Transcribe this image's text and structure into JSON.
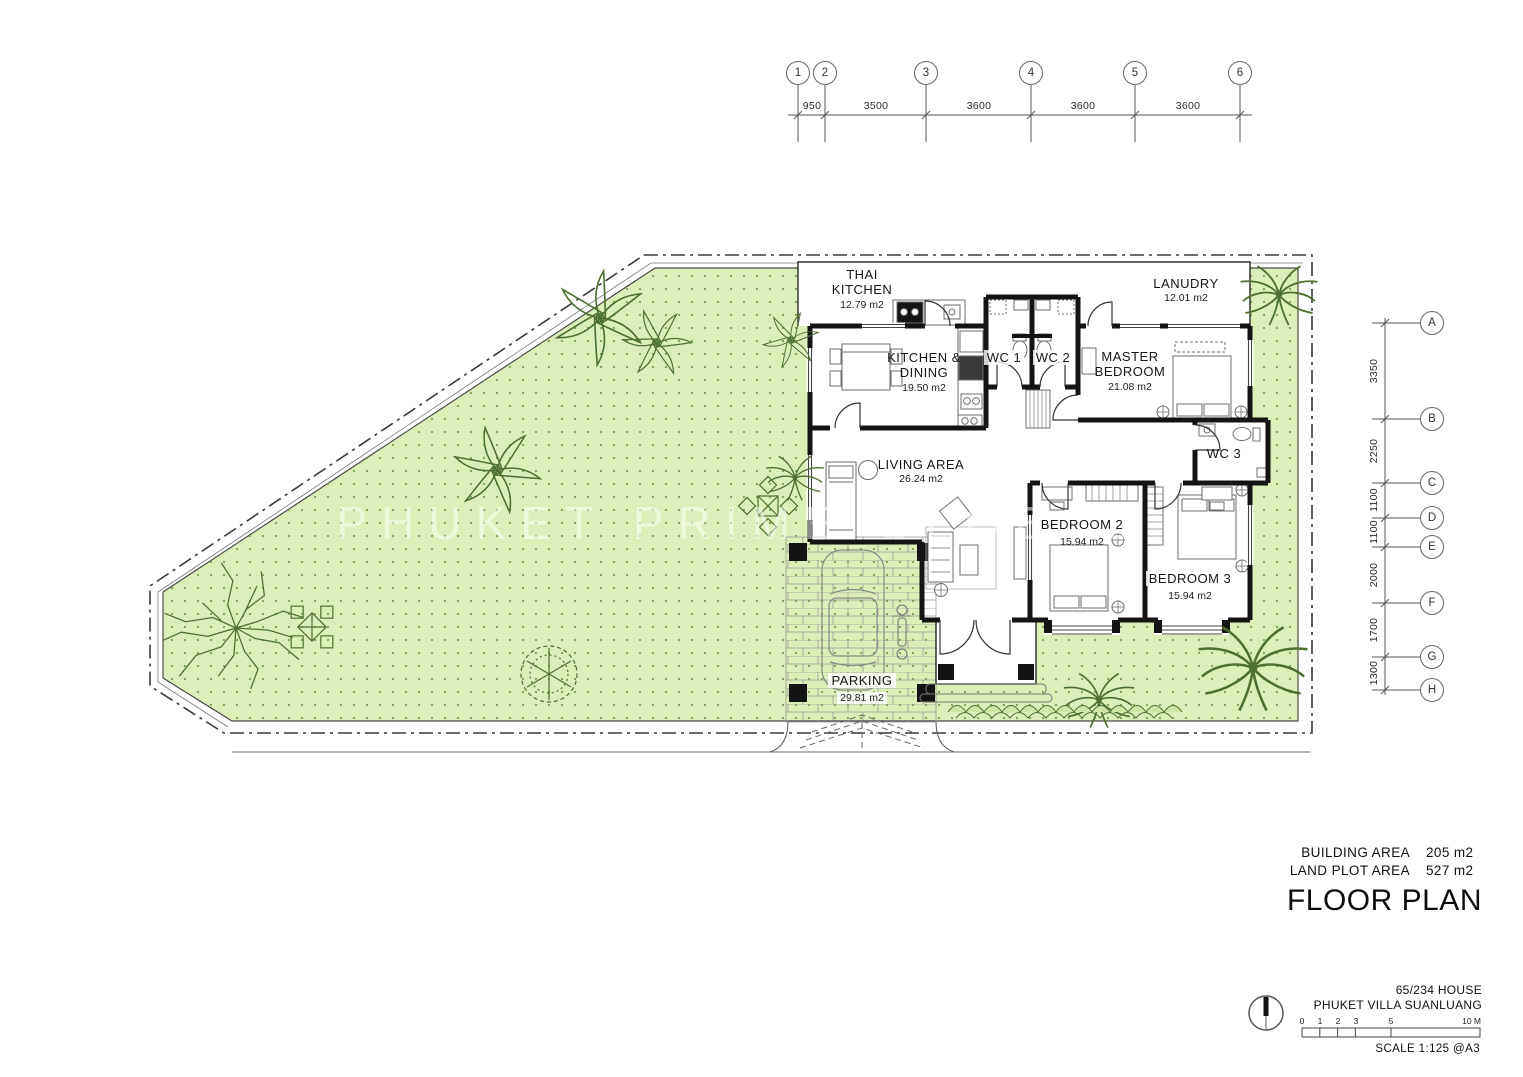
{
  "watermark": "PHUKET PRIME GLOBAL",
  "top_grid": {
    "bubbles": [
      "1",
      "2",
      "3",
      "4",
      "5",
      "6"
    ],
    "dims": [
      "950",
      "3500",
      "3600",
      "3600",
      "3600"
    ]
  },
  "right_grid": {
    "bubbles": [
      "A",
      "B",
      "C",
      "D",
      "E",
      "F",
      "G",
      "H"
    ],
    "dims": [
      "3350",
      "2250",
      "1100",
      "1100",
      "2000",
      "1700",
      "1300"
    ]
  },
  "rooms": {
    "thai_kitchen": {
      "name": "THAI KITCHEN",
      "area": "12.79 m2"
    },
    "laundry": {
      "name": "LANUDRY",
      "area": "12.01 m2"
    },
    "kitchen_dining": {
      "name": "KITCHEN & DINING",
      "area": "19.50 m2"
    },
    "wc1": {
      "name": "WC 1"
    },
    "wc2": {
      "name": "WC 2"
    },
    "master_bedroom": {
      "name": "MASTER BEDROOM",
      "area": "21.08 m2"
    },
    "living": {
      "name": "LIVING AREA",
      "area": "26.24 m2"
    },
    "wc3": {
      "name": "WC 3"
    },
    "bedroom2": {
      "name": "BEDROOM 2",
      "area": "15.94 m2"
    },
    "bedroom3": {
      "name": "BEDROOM 3",
      "area": "15.94 m2"
    },
    "parking": {
      "name": "PARKING",
      "area": "29.81 m2"
    }
  },
  "summary": {
    "building_area_label": "BUILDING AREA",
    "building_area_value": "205 m2",
    "land_plot_area_label": "LAND PLOT AREA",
    "land_plot_area_value": "527 m2",
    "drawing_title": "FLOOR PLAN"
  },
  "title_block": {
    "project_name": "65/234 HOUSE",
    "project_location": "PHUKET VILLA SUANLUANG",
    "scale_note": "SCALE 1:125 @A3",
    "scale_ticks": [
      "0",
      "1",
      "2",
      "3",
      "5",
      "10 M"
    ]
  },
  "colors": {
    "lawn": "#dcefba",
    "lawn_dot": "#7ca352",
    "wall": "#141414",
    "line": "#444444",
    "tree": "#4d7030"
  }
}
